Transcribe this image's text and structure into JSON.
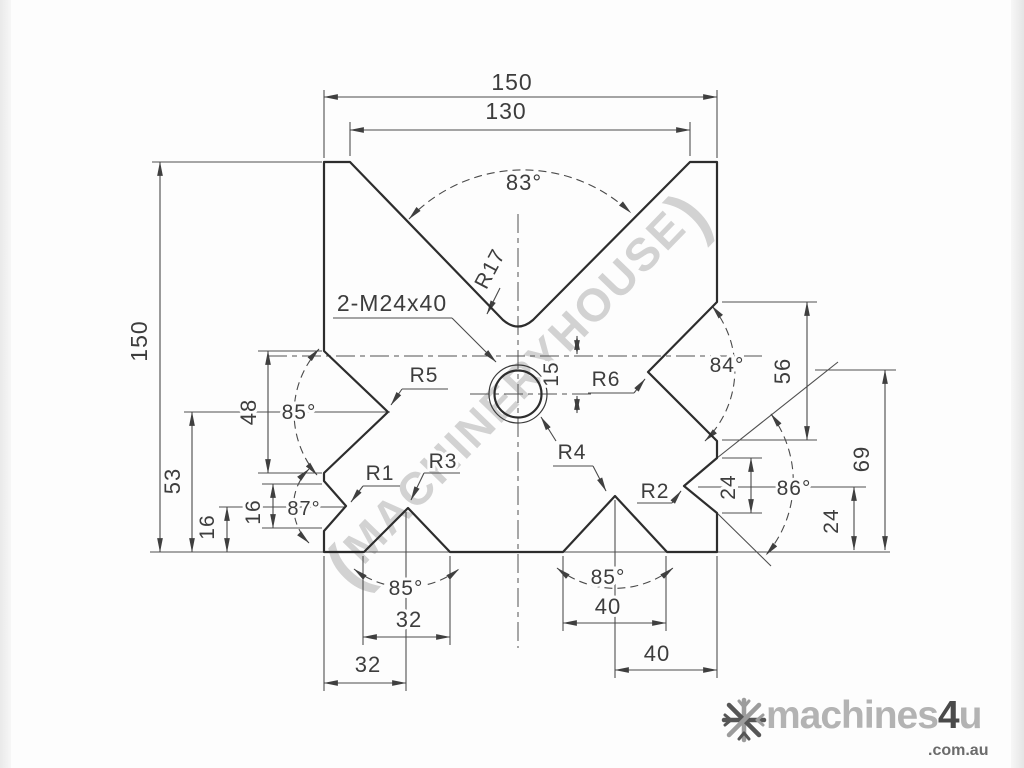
{
  "drawing_labels": {
    "top_width": "150",
    "top_opening": "130",
    "angle_top": "83°",
    "radius_top": "R17",
    "thread_note": "2-M24x40",
    "r5": "R5",
    "r6": "R6",
    "offset_15": "15",
    "angle_right": "84°",
    "dim_56": "56",
    "angle_left": "85°",
    "dim_48": "48",
    "left_height": "150",
    "dim_53": "53",
    "dim_16_outer": "16",
    "dim_16_inner": "16",
    "angle_left_small": "87°",
    "r1": "R1",
    "r3": "R3",
    "r4": "R4",
    "r2": "R2",
    "angle_right_small": "86°",
    "dim_24_inner": "24",
    "dim_24_outer": "24",
    "dim_69": "69",
    "angle_bottom_left": "85°",
    "dim_32_opening": "32",
    "dim_32_position": "32",
    "angle_bottom_right": "85°",
    "dim_40_opening": "40",
    "dim_40_position": "40"
  },
  "watermark": {
    "open": "(",
    "text": "MACHINERYHOUSE",
    "close": ")"
  },
  "logo": {
    "part1": "machines",
    "part2": "4",
    "part3": "u",
    "domain": ".com.au",
    "icon": "snowflake-icon"
  },
  "colors": {
    "line": "#2d2d2d",
    "dimension": "#4a4a4a",
    "watermark": "#7d7d7d",
    "logo_light": "#b3b3b3",
    "logo_dark": "#4a4a4a"
  }
}
